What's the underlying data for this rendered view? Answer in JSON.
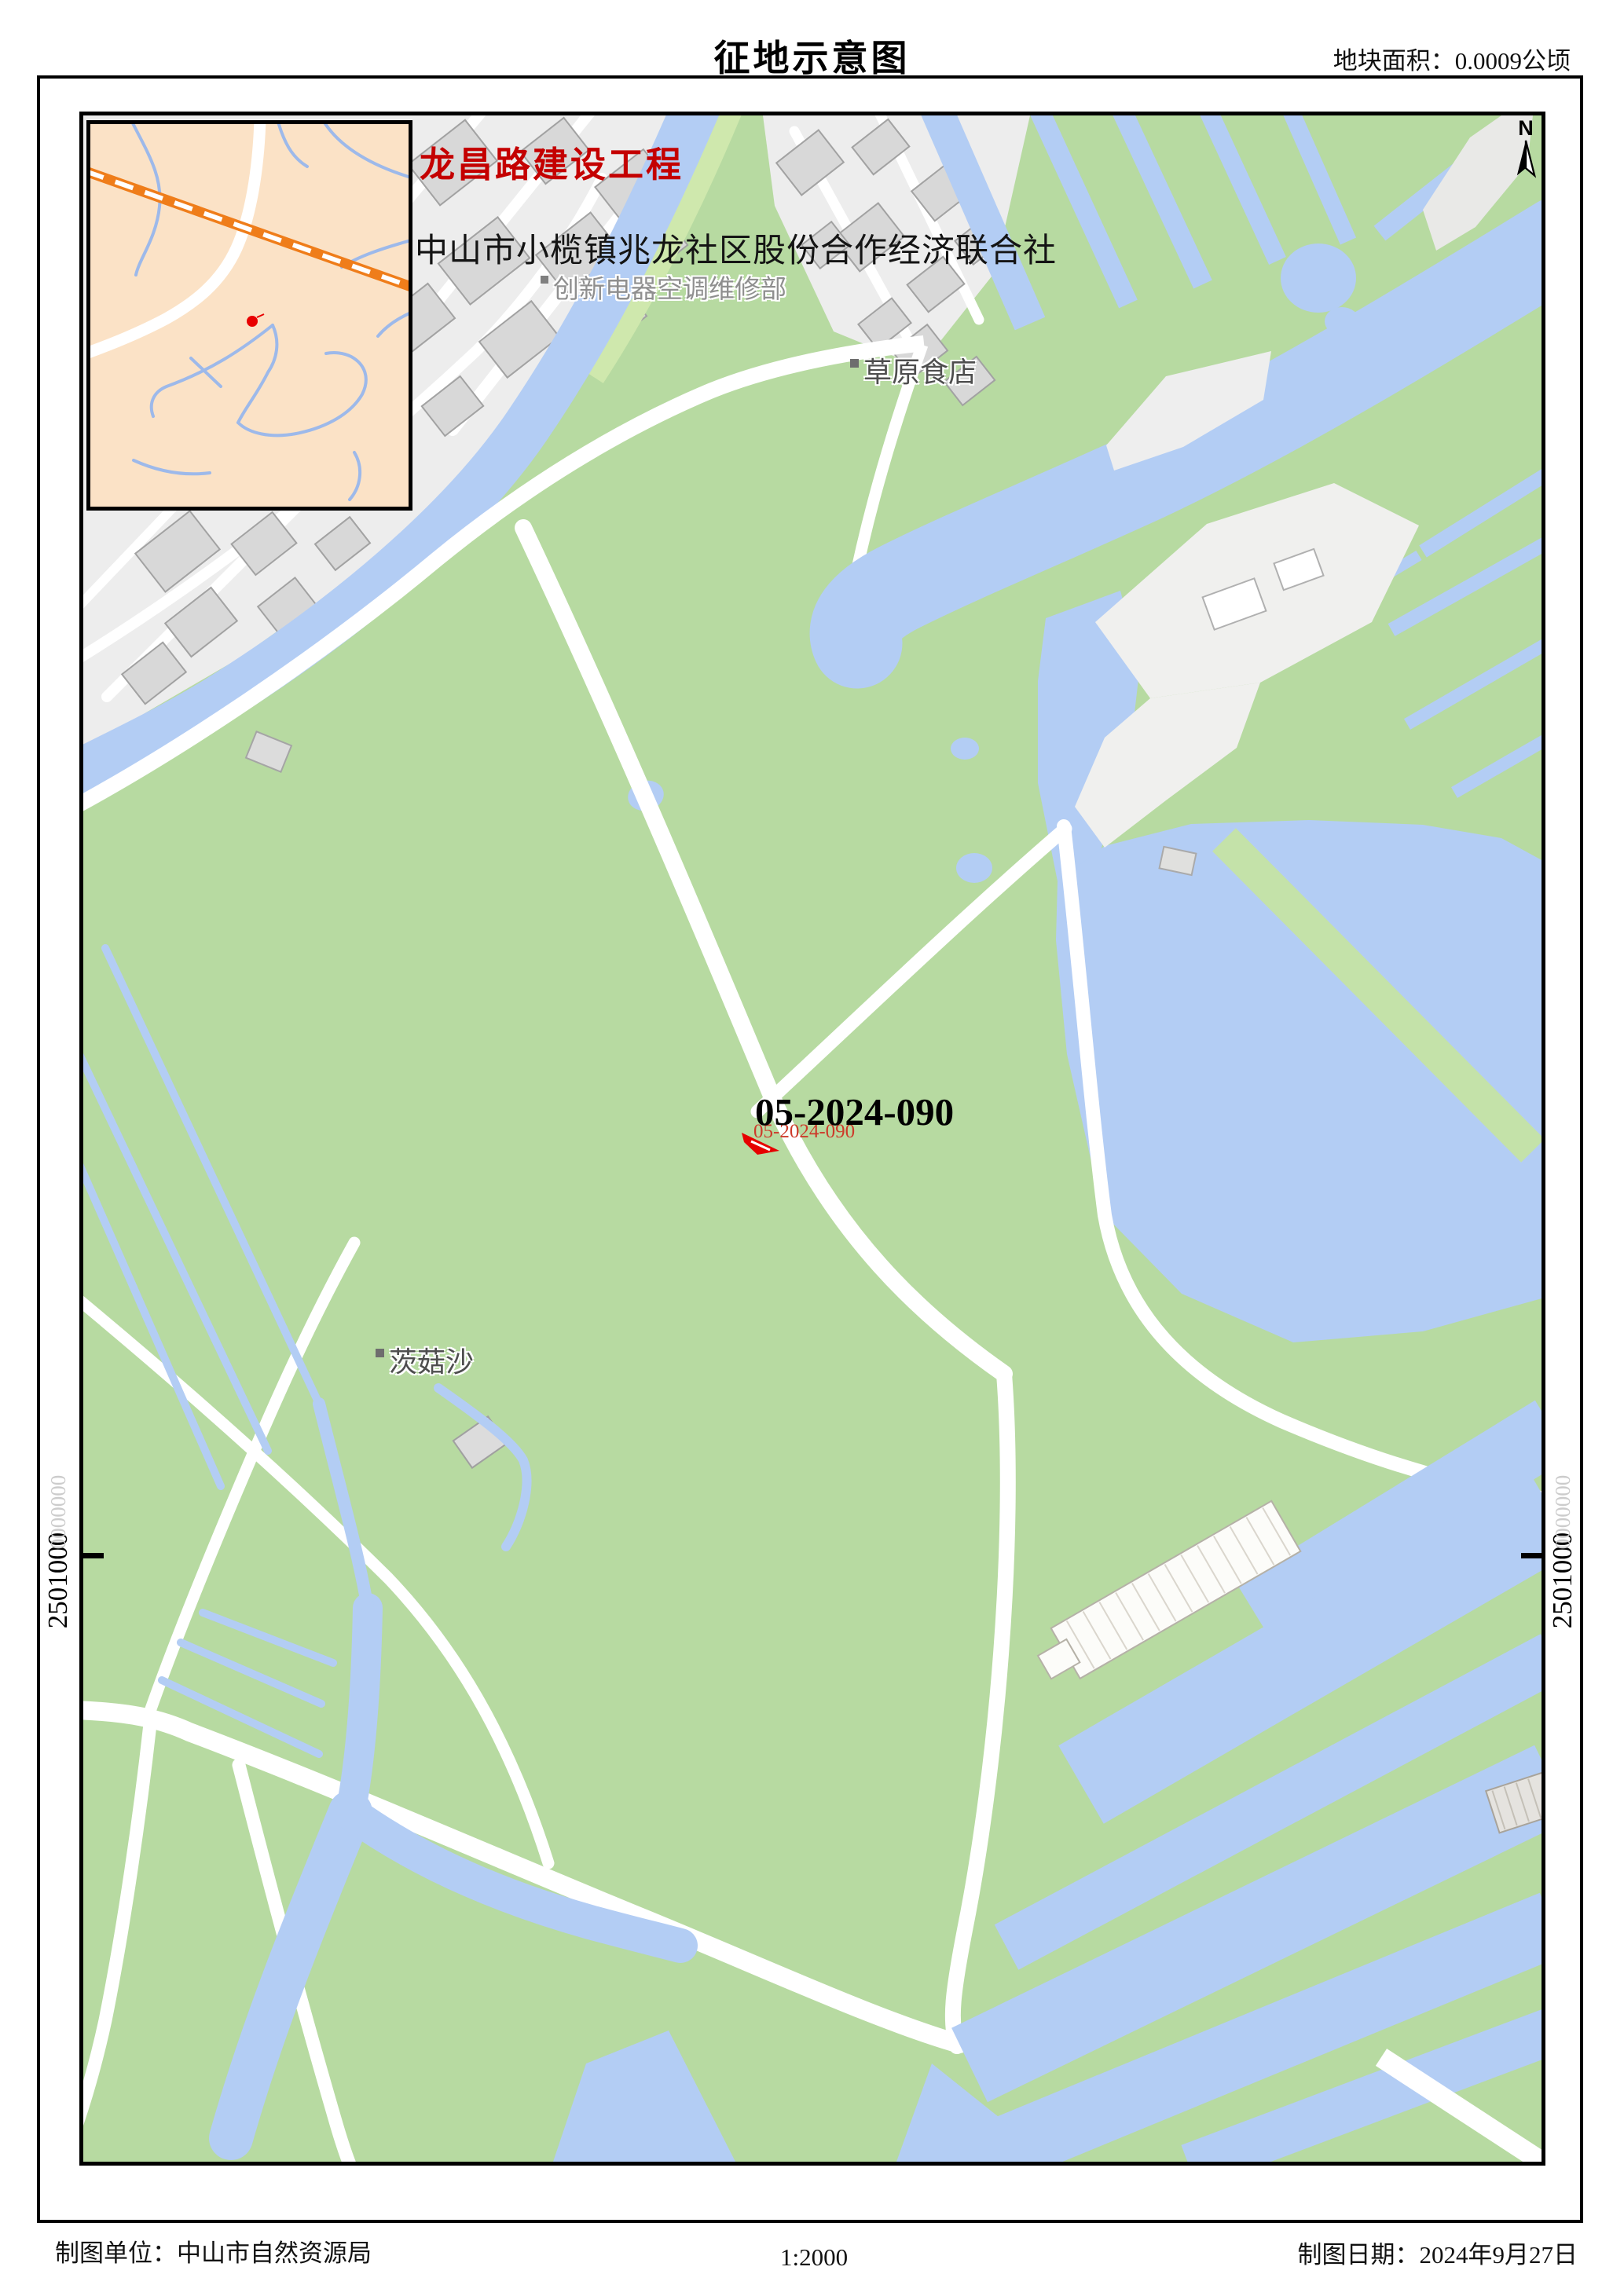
{
  "header": {
    "title": "征地示意图",
    "area_label": "地块面积：0.0009公顷"
  },
  "annotations": {
    "project_name": "龙昌路建设工程",
    "organization": "中山市小榄镇兆龙社区股份合作经济联合社",
    "parcel_id": "05-2024-090",
    "parcel_id_secondary": "05-2024-090"
  },
  "map_labels": {
    "repair_shop": "创新电器空调维修部",
    "restaurant": "草原食店",
    "village": "茨菇沙"
  },
  "compass": {
    "north_label": "N"
  },
  "grid": {
    "y_value": "2501000",
    "y_value_faint": "0000000"
  },
  "footer": {
    "agency": "制图单位：中山市自然资源局",
    "scale": "1:2000",
    "date": "制图日期：2024年9月27日"
  },
  "colors": {
    "land_green": "#b7daa1",
    "water_blue": "#b3cdf4",
    "urban_gray": "#ededed",
    "building_gray": "#d8d8d8",
    "inset_bg": "#fbe2c6",
    "railway_orange": "#ef7d1a",
    "parcel_red": "#e60000",
    "project_red": "#c40000"
  }
}
